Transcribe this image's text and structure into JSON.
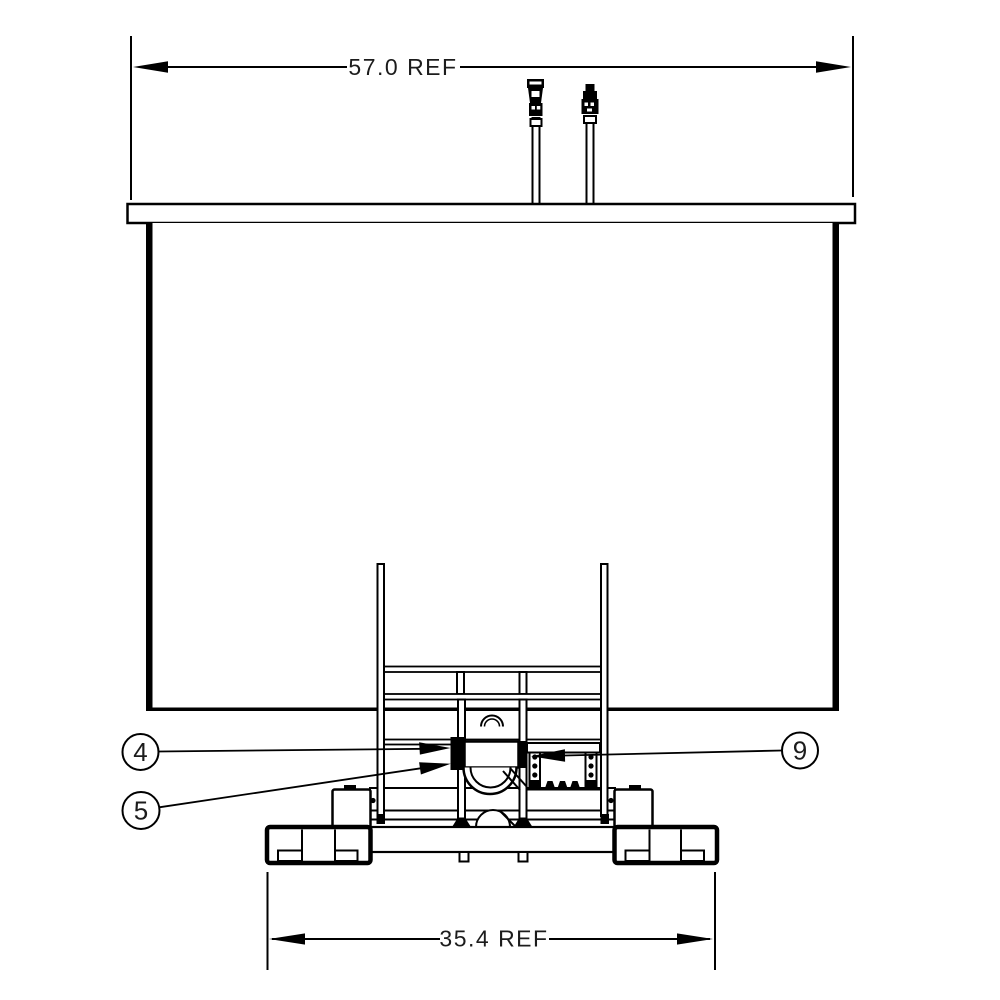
{
  "drawing": {
    "type": "engineering-front-view",
    "colors": {
      "line": "#000000",
      "background": "#ffffff",
      "text": "#1c1c1c"
    },
    "dimensions": {
      "overall_width": {
        "label": "57.0 REF"
      },
      "base_width": {
        "label": "35.4 REF"
      }
    },
    "callouts": {
      "item_4": {
        "number": "4"
      },
      "item_5": {
        "number": "5"
      },
      "item_9": {
        "number": "9"
      }
    }
  }
}
